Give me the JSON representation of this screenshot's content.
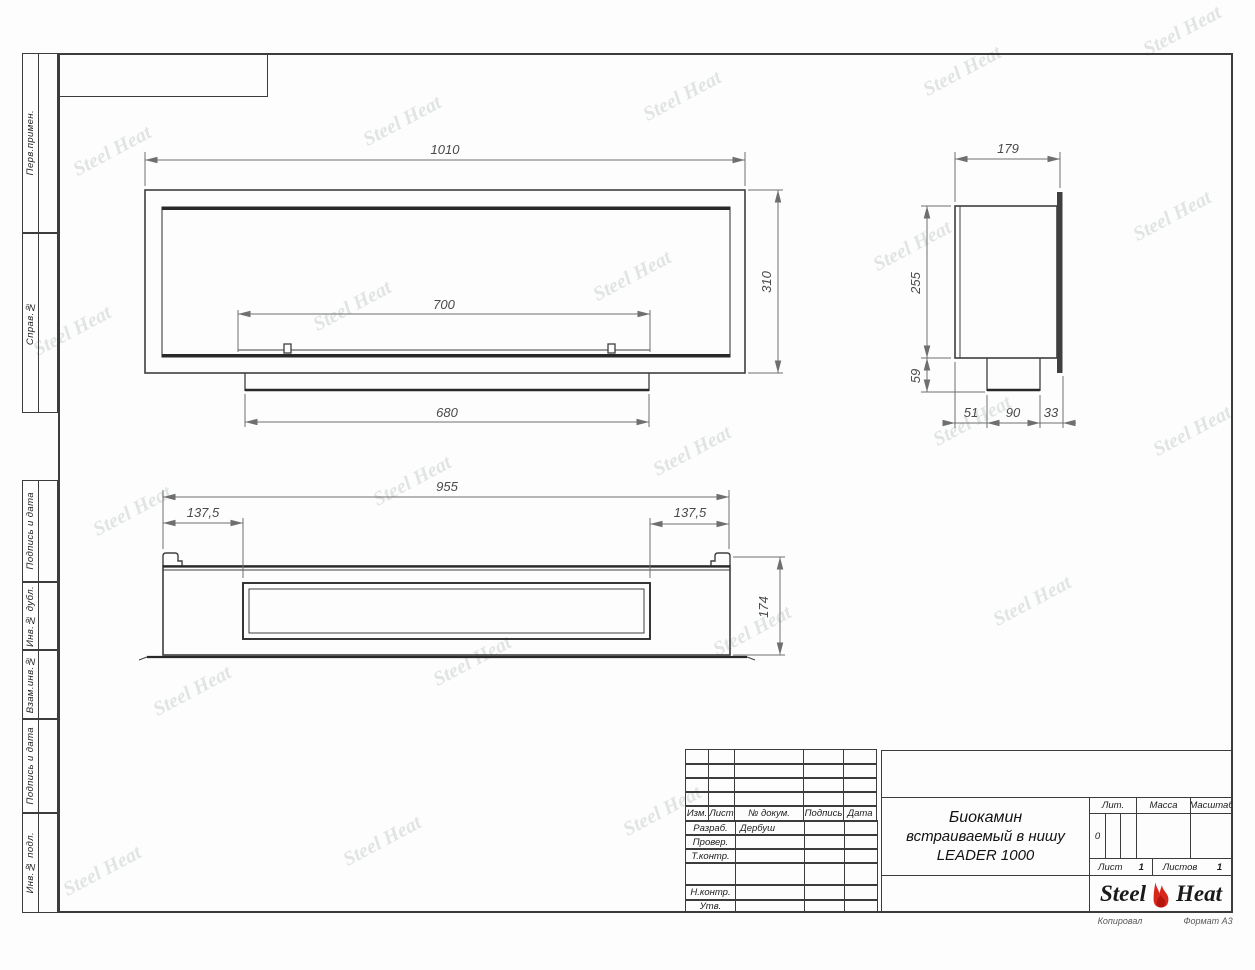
{
  "sheet": {
    "left_labels": [
      "Перв.примен.",
      "Справ.№",
      "Подпись и дата",
      "Инв.№ дубл.",
      "Взам.инв.№",
      "Подпись и дата",
      "Инв.№ подл."
    ],
    "footer": {
      "copied": "Копировал",
      "format": "Формат А3"
    }
  },
  "watermark": {
    "text": "Steel Heat"
  },
  "views": {
    "front": {
      "width": "1010",
      "height": "310",
      "burner": "700",
      "tray": "680"
    },
    "side": {
      "depth": "179",
      "height": "255",
      "lower": "59",
      "seg1": "51",
      "seg2": "90",
      "seg3": "33"
    },
    "plan": {
      "width": "955",
      "offset_left": "137,5",
      "offset_right": "137,5",
      "depth": "174"
    }
  },
  "title_block": {
    "cols": {
      "izm": "Изм.",
      "list": "Лист",
      "doc": "№ докум.",
      "sign": "Подпись",
      "date": "Дата"
    },
    "rows": {
      "razrab": "Разраб.",
      "prover": "Провер.",
      "tkontr": "Т.контр.",
      "nkontr": "Н.контр.",
      "utv": "Утв."
    },
    "developer": "Дербуш",
    "title_line1": "Биокамин",
    "title_line2": "встраиваемый в нишу",
    "title_line3": "LEADER 1000",
    "lit_label": "Лит.",
    "lit_value": "0",
    "mass_label": "Масса",
    "scale_label": "Масштаб",
    "sheet_label": "Лист",
    "sheet_value": "1",
    "sheets_label": "Листов",
    "sheets_value": "1",
    "logo_left": "Steel",
    "logo_right": "Heat"
  },
  "colors": {
    "line": "#3c3c3c",
    "dim": "#6f6f6f",
    "flame": "#d9261c",
    "watermark": "rgba(125,140,132,0.25)"
  }
}
